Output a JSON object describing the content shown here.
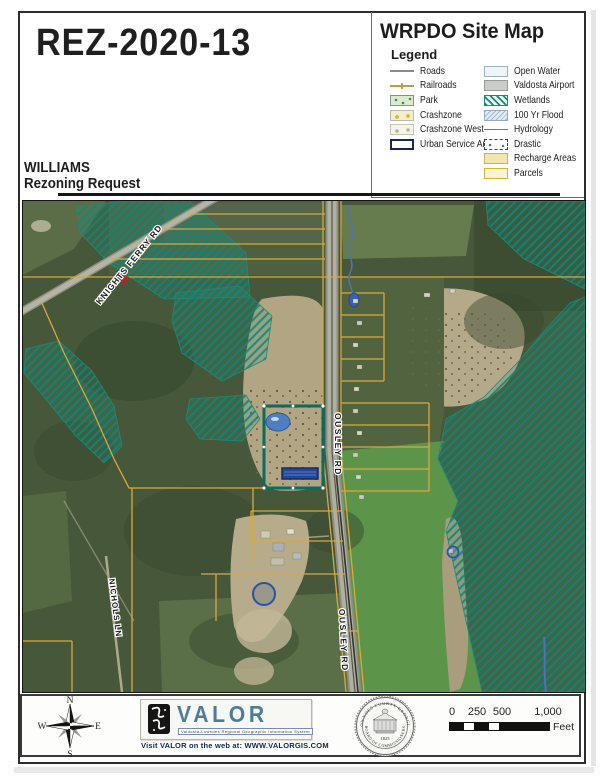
{
  "header": {
    "case_number": "REZ-2020-13",
    "map_title": "WRPDO Site Map",
    "applicant": "WILLIAMS",
    "request": "Rezoning Request"
  },
  "legend": {
    "title": "Legend",
    "left": [
      {
        "label": "Roads"
      },
      {
        "label": "Railroads"
      },
      {
        "label": "Park"
      },
      {
        "label": "Crashzone"
      },
      {
        "label": "Crashzone West"
      },
      {
        "label": "Urban Service Area"
      }
    ],
    "right": [
      {
        "label": "Open Water"
      },
      {
        "label": "Valdosta Airport"
      },
      {
        "label": "Wetlands"
      },
      {
        "label": "100 Yr Flood"
      },
      {
        "label": "Hydrology"
      },
      {
        "label": "Drastic"
      },
      {
        "label": "Recharge Areas"
      },
      {
        "label": "Parcels"
      }
    ]
  },
  "map": {
    "labels": {
      "knights_ferry_rd": "KNIGHTS FERRY RD",
      "ousley_rd": "OUSLEY RD",
      "ousley_rd_2": "OUSLEY RD",
      "nichols_ln": "NICHOLS LN"
    }
  },
  "footer": {
    "compass": {
      "n": "N",
      "s": "S",
      "e": "E",
      "w": "W"
    },
    "valor": {
      "name": "VALOR",
      "tagline": "Valdosta-Lowndes Regional Geographic Information System",
      "web": "Visit VALOR on the web at: WWW.VALORGIS.COM"
    },
    "seal": {
      "arc_top": "LOWNDES COUNTY GEORGIA",
      "arc_bottom": "BOARD OF COMMISSIONERS",
      "year": "1825"
    },
    "scale": {
      "t0": "0",
      "t1": "250",
      "t2": "500",
      "t3": "1,000",
      "unit": "Feet"
    }
  },
  "colors": {
    "wetlands_teal": "#1d8a79",
    "parcel_yellow": "#d9a93f",
    "subject_outline": "#0b6b5f",
    "hydrology_blue": "#4a74b4",
    "urban_service_navy": "#1a2560",
    "valor_blue": "#4d7c9d"
  }
}
